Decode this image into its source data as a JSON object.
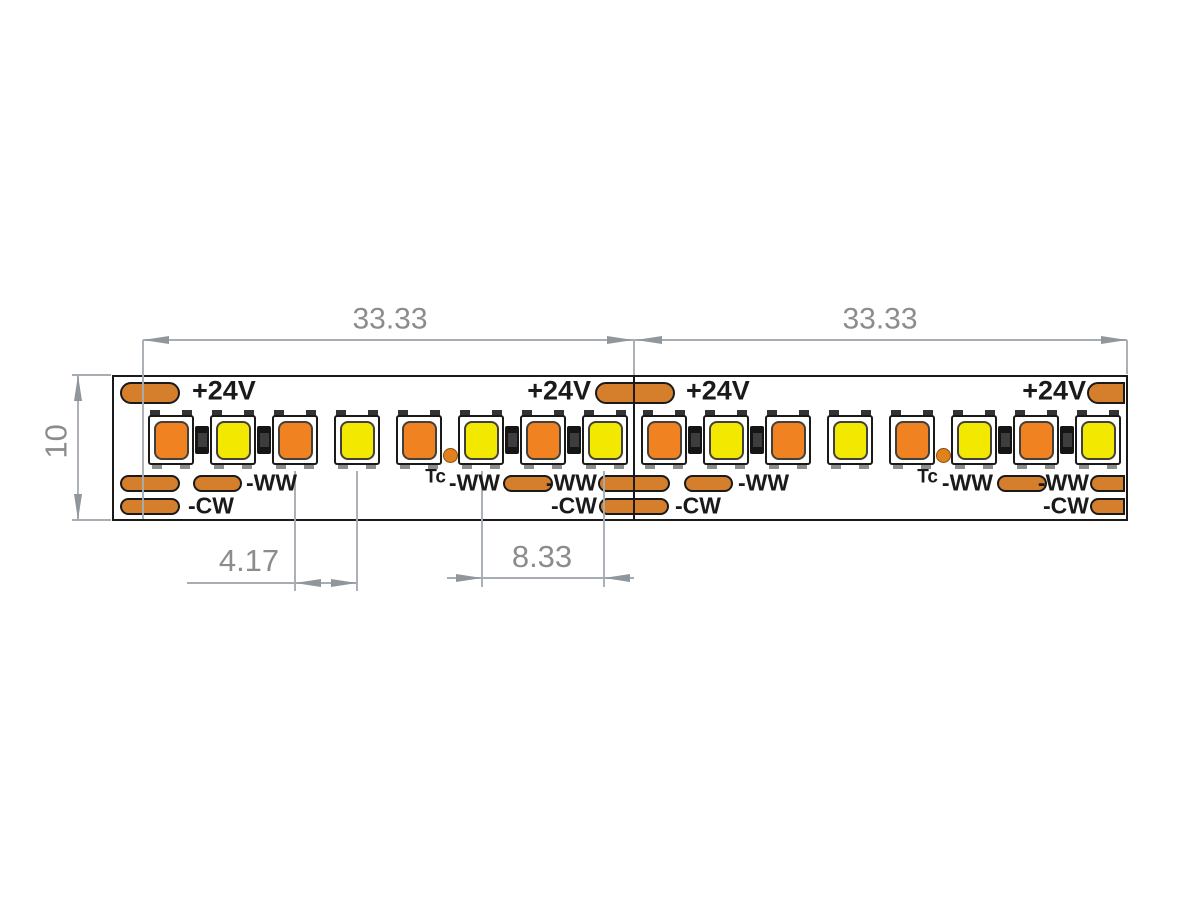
{
  "page": {
    "width": 1200,
    "height": 900,
    "background": "#ffffff"
  },
  "drawing": {
    "colors": {
      "pad_orange": "#d57e2b",
      "led_warm_orange": "#f08222",
      "led_cool_yellow": "#f3e900",
      "tc_dot_orange": "#df821e",
      "outline_black": "#1a1a1a",
      "dim_line_gray": "#a7adb3",
      "dim_text_gray": "#8c8c8c",
      "tab_dark": "#333333",
      "foot_gray": "#8c8c8c",
      "resistor_black": "#151515",
      "resistor_core": "#3d3d3d"
    },
    "strip": {
      "x": 112,
      "y": 375,
      "width": 1016,
      "height": 146
    },
    "cut_lines_x": [
      634
    ],
    "leds": [
      {
        "cx": 171,
        "color": "warm"
      },
      {
        "cx": 233,
        "color": "cool"
      },
      {
        "cx": 295,
        "color": "warm"
      },
      {
        "cx": 357,
        "color": "cool"
      },
      {
        "cx": 419,
        "color": "warm"
      },
      {
        "cx": 481,
        "color": "cool"
      },
      {
        "cx": 543,
        "color": "warm"
      },
      {
        "cx": 605,
        "color": "cool"
      },
      {
        "cx": 664,
        "color": "warm"
      },
      {
        "cx": 726,
        "color": "cool"
      },
      {
        "cx": 788,
        "color": "warm"
      },
      {
        "cx": 850,
        "color": "cool"
      },
      {
        "cx": 912,
        "color": "warm"
      },
      {
        "cx": 974,
        "color": "cool"
      },
      {
        "cx": 1036,
        "color": "warm"
      },
      {
        "cx": 1098,
        "color": "cool"
      }
    ],
    "resistors_cx": [
      202,
      264,
      512,
      574,
      695,
      757,
      1005,
      1067
    ],
    "tc_dots_cx": [
      450,
      943
    ],
    "pads": {
      "top_row": {
        "y": 382,
        "height": 22,
        "items": [
          {
            "x": 120,
            "w": 60
          },
          {
            "x": 595,
            "w": 80
          },
          {
            "x": 1087,
            "w": 38,
            "cut_right": true
          }
        ]
      },
      "ww_row": {
        "y": 475,
        "height": 17,
        "items": [
          {
            "x": 120,
            "w": 60
          },
          {
            "x": 193,
            "w": 49
          },
          {
            "x": 503,
            "w": 50
          },
          {
            "x": 598,
            "w": 72
          },
          {
            "x": 684,
            "w": 49
          },
          {
            "x": 997,
            "w": 50
          },
          {
            "x": 1090,
            "w": 35,
            "cut_right": true
          }
        ]
      },
      "cw_row": {
        "y": 498,
        "height": 17,
        "items": [
          {
            "x": 120,
            "w": 60
          },
          {
            "x": 599,
            "w": 70
          },
          {
            "x": 1090,
            "w": 35,
            "cut_right": true
          }
        ]
      }
    },
    "text_labels": [
      {
        "text": "+24V",
        "x": 192,
        "y": 392,
        "anchor": "start",
        "size": 27
      },
      {
        "text": "+24V",
        "x": 591,
        "y": 392,
        "anchor": "end",
        "size": 27
      },
      {
        "text": "+24V",
        "x": 686,
        "y": 392,
        "anchor": "start",
        "size": 27
      },
      {
        "text": "+24V",
        "x": 1086,
        "y": 392,
        "anchor": "end",
        "size": 27
      },
      {
        "text": "-WW",
        "x": 246,
        "y": 484,
        "anchor": "start",
        "size": 23
      },
      {
        "text": "-WW",
        "x": 500,
        "y": 484,
        "anchor": "end",
        "size": 23
      },
      {
        "text": "-WW",
        "x": 597,
        "y": 484,
        "anchor": "end",
        "size": 23
      },
      {
        "text": "-WW",
        "x": 738,
        "y": 484,
        "anchor": "start",
        "size": 23
      },
      {
        "text": "-WW",
        "x": 993,
        "y": 484,
        "anchor": "end",
        "size": 23
      },
      {
        "text": "-WW",
        "x": 1089,
        "y": 484,
        "anchor": "end",
        "size": 23
      },
      {
        "text": "-CW",
        "x": 188,
        "y": 507,
        "anchor": "start",
        "size": 23
      },
      {
        "text": "-CW",
        "x": 597,
        "y": 507,
        "anchor": "end",
        "size": 23
      },
      {
        "text": "-CW",
        "x": 675,
        "y": 507,
        "anchor": "start",
        "size": 23
      },
      {
        "text": "-CW",
        "x": 1089,
        "y": 507,
        "anchor": "end",
        "size": 23
      },
      {
        "text": "Tc",
        "x": 446,
        "y": 478,
        "anchor": "end",
        "size": 19
      },
      {
        "text": "Tc",
        "x": 938,
        "y": 478,
        "anchor": "end",
        "size": 19
      }
    ],
    "dim_texts": [
      {
        "text": "33.33",
        "cx": 390,
        "cy": 320,
        "size": 30
      },
      {
        "text": "33.33",
        "cx": 880,
        "cy": 320,
        "size": 30
      },
      {
        "text": "4.17",
        "cx": 249,
        "cy": 561,
        "size": 31
      },
      {
        "text": "8.33",
        "cx": 542,
        "cy": 557,
        "size": 31
      },
      {
        "text": "10",
        "cx": 56,
        "cy": 442,
        "size": 31,
        "rotate": -90
      }
    ],
    "gray_h_lines": [
      [
        143,
        1127,
        340
      ],
      [
        72,
        111,
        375
      ],
      [
        72,
        111,
        520
      ],
      [
        187,
        357,
        583
      ],
      [
        447,
        634,
        578
      ]
    ],
    "gray_v_lines": [
      [
        143,
        340,
        519
      ],
      [
        634,
        340,
        376
      ],
      [
        1127,
        340,
        374
      ],
      [
        78,
        375,
        520
      ],
      [
        295,
        471,
        591
      ],
      [
        357,
        471,
        591
      ],
      [
        482,
        471,
        587
      ],
      [
        604,
        471,
        587
      ]
    ],
    "arrows": [
      {
        "x": 143,
        "y": 340,
        "dir": "left"
      },
      {
        "x": 633,
        "y": 340,
        "dir": "right"
      },
      {
        "x": 636,
        "y": 340,
        "dir": "left"
      },
      {
        "x": 1127,
        "y": 340,
        "dir": "right"
      },
      {
        "x": 78,
        "y": 375,
        "dir": "up"
      },
      {
        "x": 78,
        "y": 520,
        "dir": "down"
      },
      {
        "x": 295,
        "y": 583,
        "dir": "left"
      },
      {
        "x": 357,
        "y": 583,
        "dir": "right"
      },
      {
        "x": 482,
        "y": 578,
        "dir": "right"
      },
      {
        "x": 604,
        "y": 578,
        "dir": "left"
      }
    ]
  }
}
